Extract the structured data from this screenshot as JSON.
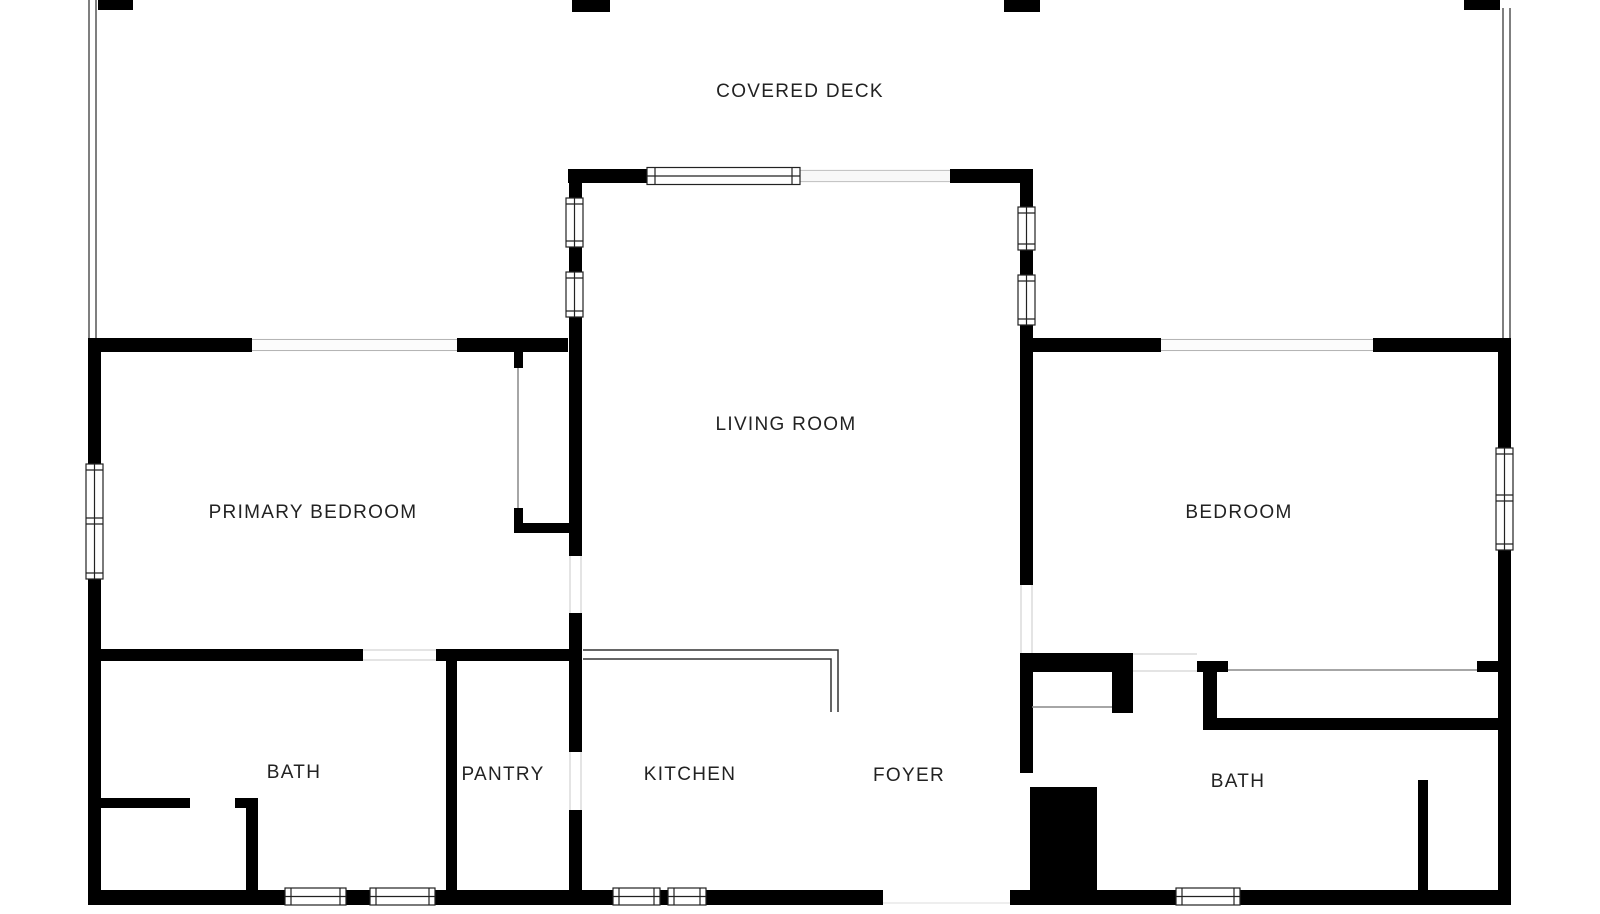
{
  "document": {
    "type": "floor-plan",
    "view": "2d-black-and-white"
  },
  "rooms": {
    "covered_deck": {
      "label": "COVERED DECK"
    },
    "living_room": {
      "label": "LIVING ROOM"
    },
    "primary_bedroom": {
      "label": "PRIMARY BEDROOM"
    },
    "bedroom": {
      "label": "BEDROOM"
    },
    "bath_left": {
      "label": "BATH"
    },
    "pantry": {
      "label": "PANTRY"
    },
    "kitchen": {
      "label": "KITCHEN"
    },
    "foyer": {
      "label": "FOYER"
    },
    "bath_right": {
      "label": "BATH"
    }
  },
  "colors": {
    "wall": "#000000",
    "background": "#ffffff",
    "label_text": "#222222",
    "window_frame": "#222222",
    "opening_line": "#c8c8c8",
    "closet_door_line": "#888888",
    "deck_rail": "#555555"
  }
}
